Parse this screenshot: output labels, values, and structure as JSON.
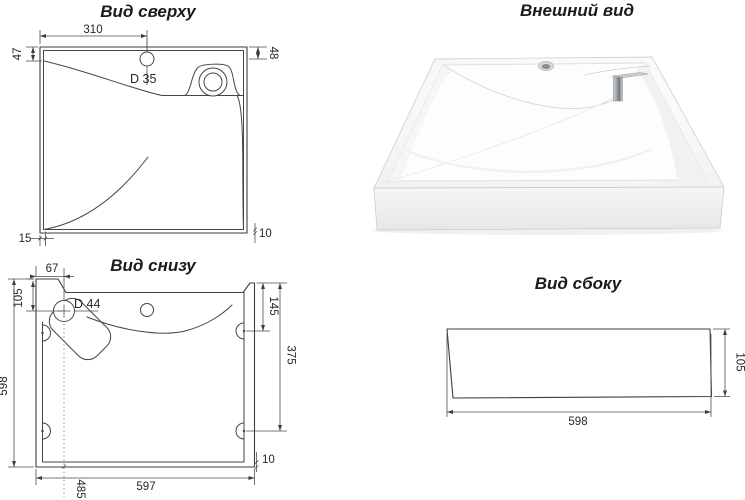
{
  "views": {
    "top_view": {
      "title": "Вид сверху",
      "dim_width_to_hole": "310",
      "dim_left_inset": "47",
      "dim_right_inset": "48",
      "faucet_hole_label": "D 35",
      "dim_bottom_thickness": "15",
      "dim_rim_thickness": "10"
    },
    "external_view": {
      "title": "Внешний вид"
    },
    "bottom_view": {
      "title": "Вид снизу",
      "dim_drain_from_left": "67",
      "dim_drain_from_top": "105",
      "drain_label": "D 44",
      "dim_depth": "598",
      "dim_hole_from_top": "145",
      "dim_hole_span": "375",
      "dim_width": "597",
      "dim_drain_from_bottom": "485",
      "dim_rim_thickness": "10"
    },
    "side_view": {
      "title": "Вид сбоку",
      "dim_width": "598",
      "dim_height": "105"
    }
  },
  "colors": {
    "line": "#3e3e3e",
    "dimension_text": "#262626",
    "background": "#ffffff",
    "chrome": "#9aa0a6"
  }
}
